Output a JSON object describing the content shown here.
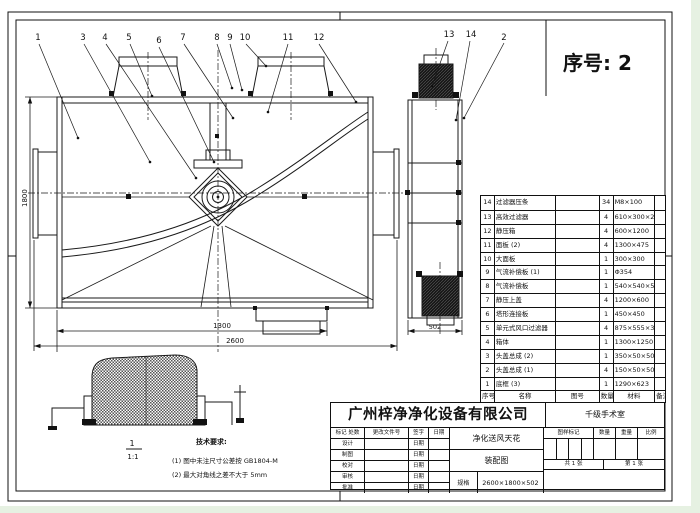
{
  "serial": {
    "text": "序号: 2"
  },
  "balloons": {
    "n1": "1",
    "n2": "2",
    "n3": "3",
    "n4": "4",
    "n5": "5",
    "n6": "6",
    "n7": "7",
    "n8": "8",
    "n9": "9",
    "n10": "10",
    "n11": "11",
    "n12": "12",
    "n13": "13",
    "n14": "14"
  },
  "dims": {
    "height": "1800",
    "half_width": "1300",
    "total_width": "2600",
    "depth": "502"
  },
  "detail": {
    "label": "1",
    "scale": "1:1"
  },
  "notes": {
    "title": "技术要求:",
    "line1": "(1) 图中未注尺寸公差按 GB1804-M",
    "line2": "(2) 最大对角线之差不大于 5mm"
  },
  "parts": {
    "header": {
      "no": "序号",
      "name": "名称",
      "drawing_no": "图号",
      "qty": "数量",
      "material": "材料",
      "remark": "备注"
    },
    "rows": [
      {
        "no": "14",
        "name": "过滤器压条",
        "qty": "34",
        "spec": "M8×100"
      },
      {
        "no": "13",
        "name": "高效过滤器",
        "qty": "4",
        "spec": "610×300×292"
      },
      {
        "no": "12",
        "name": "静压箱",
        "qty": "4",
        "spec": "600×1200"
      },
      {
        "no": "11",
        "name": "面板 (2)",
        "qty": "4",
        "spec": "1300×475"
      },
      {
        "no": "10",
        "name": "大面板",
        "qty": "1",
        "spec": "300×300"
      },
      {
        "no": "9",
        "name": "气流补偿板 (1)",
        "qty": "1",
        "spec": "Φ354"
      },
      {
        "no": "8",
        "name": "气流补偿板",
        "qty": "1",
        "spec": "540×540×50"
      },
      {
        "no": "7",
        "name": "静压上盖",
        "qty": "4",
        "spec": "1200×600"
      },
      {
        "no": "6",
        "name": "塔形连接板",
        "qty": "1",
        "spec": "450×450"
      },
      {
        "no": "5",
        "name": "单元式风口过滤器",
        "qty": "4",
        "spec": "875×555×365"
      },
      {
        "no": "4",
        "name": "箱体",
        "qty": "1",
        "spec": "1300×1250"
      },
      {
        "no": "3",
        "name": "头盖总成 (2)",
        "qty": "1",
        "spec": "350×50×50"
      },
      {
        "no": "2",
        "name": "头盖总成 (1)",
        "qty": "4",
        "spec": "150×50×50"
      },
      {
        "no": "1",
        "name": "底框 (3)",
        "qty": "1",
        "spec": "1290×623"
      }
    ]
  },
  "titleblock": {
    "company": "广州梓净净化设备有限公司",
    "project": "千级手术室",
    "product": "净化送风天花",
    "drawing_type": "装配图",
    "spec_label": "规格",
    "spec_value": "2600×1800×502",
    "rev_header": {
      "c1": "标记 处数",
      "c2": "更改文件号",
      "c3": "签字",
      "c4": "日期"
    },
    "sign_rows": [
      {
        "label": "设计",
        "date": "日期"
      },
      {
        "label": "制图",
        "date": "日期"
      },
      {
        "label": "校对",
        "date": "日期"
      },
      {
        "label": "审核",
        "date": "日期"
      },
      {
        "label": "批准",
        "date": "日期"
      }
    ],
    "right_header": {
      "c1": "图样标记",
      "c2": "数量",
      "c3": "重量",
      "c4": "比例"
    },
    "sheet": {
      "total": "共 1 张",
      "page": "第 1 张"
    }
  }
}
